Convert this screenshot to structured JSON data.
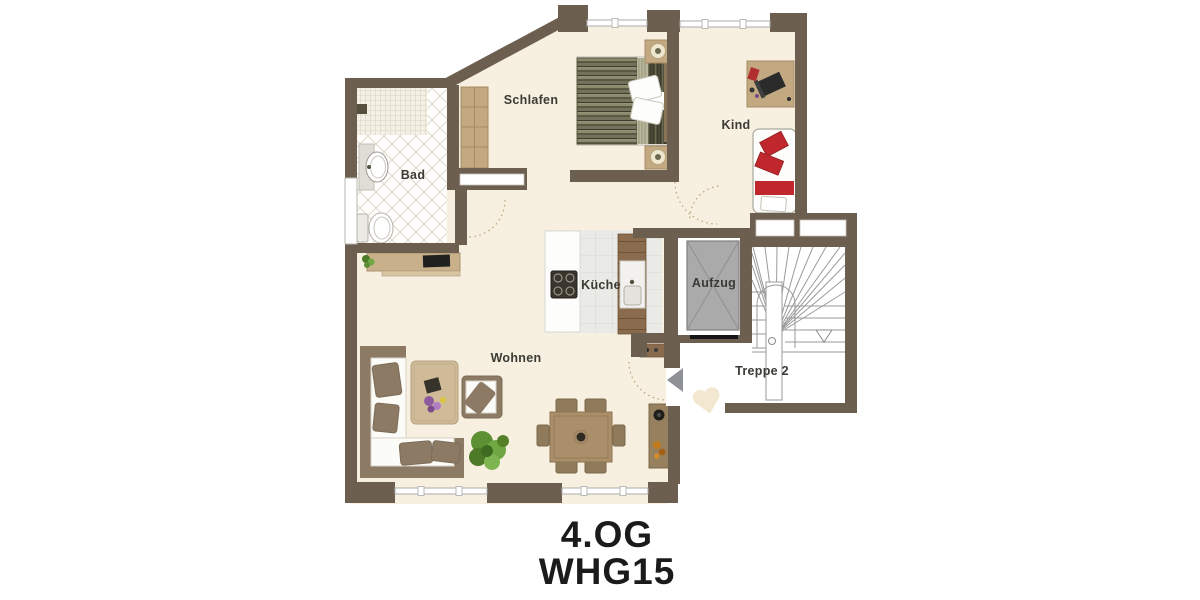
{
  "title": {
    "floor": "4.OG",
    "apartment": "WHG15"
  },
  "rooms": {
    "bad": {
      "label": "Bad"
    },
    "schlafen": {
      "label": "Schlafen"
    },
    "kind": {
      "label": "Kind"
    },
    "kueche": {
      "label": "Küche"
    },
    "aufzug": {
      "label": "Aufzug"
    },
    "wohnen": {
      "label": "Wohnen"
    },
    "treppe": {
      "label": "Treppe 2"
    }
  },
  "colors": {
    "wall": "#6d5f50",
    "floor_beige": "#f7f0e0",
    "accent_red": "#c1282d",
    "elevator_fill": "#aaaaaa",
    "label_text": "#3b3a35",
    "title_text": "#1b1b1b"
  }
}
